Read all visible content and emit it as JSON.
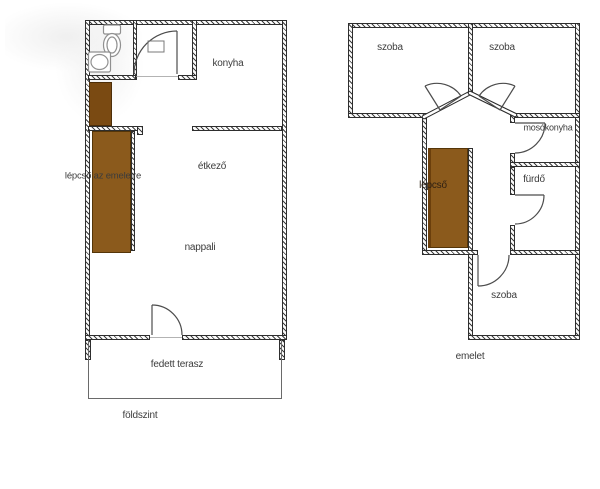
{
  "colors": {
    "wall": "#2e2e2e",
    "stair_main": "#8b5a1c",
    "stair_upper_run": "#7a4a12",
    "text": "#3c3c3c",
    "fixture": "#909090",
    "door": "#4c4c4c"
  },
  "ground_floor": {
    "caption": "földszint",
    "labels": {
      "kitchen": "konyha",
      "dining": "étkező",
      "stairs": "lépcső az emeletre",
      "living": "nappali",
      "terrace": "fedett terasz"
    }
  },
  "upper_floor": {
    "caption": "emelet",
    "labels": {
      "room_top_left": "szoba",
      "room_top_right": "szoba",
      "laundry": "mosókonyha",
      "bathroom": "fürdő",
      "stairs": "lépcső",
      "room_bottom": "szoba"
    }
  }
}
